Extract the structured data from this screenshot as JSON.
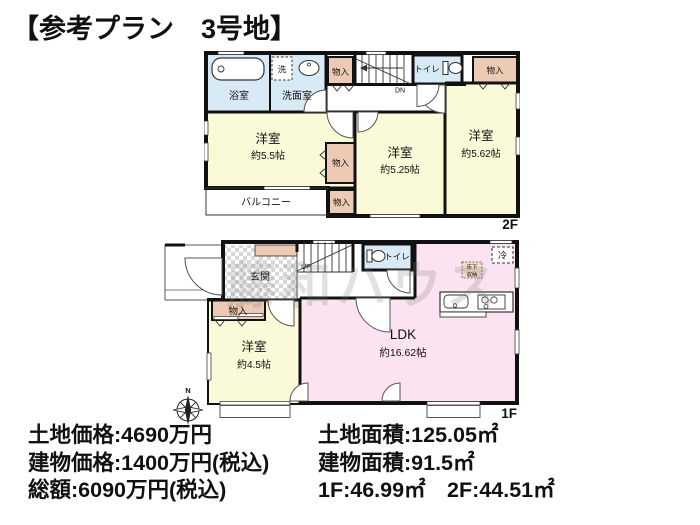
{
  "title": "【参考プラン　3号地】",
  "watermark": "藤和ハウス",
  "compass": {
    "north": "N"
  },
  "f2": {
    "floor_label": "2F",
    "bath": "浴室",
    "washer": "洗",
    "washroom": "洗面室",
    "closet": "物入",
    "stairs": "DN",
    "toilet": "トイレ",
    "room1": {
      "name": "洋室",
      "size": "約5.5帖"
    },
    "room2": {
      "name": "洋室",
      "size": "約5.25帖"
    },
    "room3": {
      "name": "洋室",
      "size": "約5.62帖"
    },
    "balcony": "バルコニー"
  },
  "f1": {
    "floor_label": "1F",
    "entrance": "玄関",
    "stairs": "UP",
    "toilet": "トイレ",
    "closet": "物入",
    "fridge": "冷",
    "underfloor_line1": "床下",
    "underfloor_line2": "収納",
    "room": {
      "name": "洋室",
      "size": "約4.5帖"
    },
    "ldk": {
      "name": "LDK",
      "size": "約16.62帖"
    }
  },
  "pricing": {
    "land_price": "土地価格:4690万円",
    "building_price": "建物価格:1400万円(税込)",
    "total_price": "総額:6090万円(税込)",
    "land_area": "土地面積:125.05㎡",
    "building_area": "建物面積:91.5㎡",
    "floor_area": "1F:46.99㎡　2F:44.51㎡"
  },
  "colors": {
    "room": "#fafad8",
    "wet": "#d7eaf6",
    "closet": "#eccab4",
    "ldk": "#fbe3f1",
    "underfloor": "#f2d9c8",
    "wall": "#111111"
  }
}
